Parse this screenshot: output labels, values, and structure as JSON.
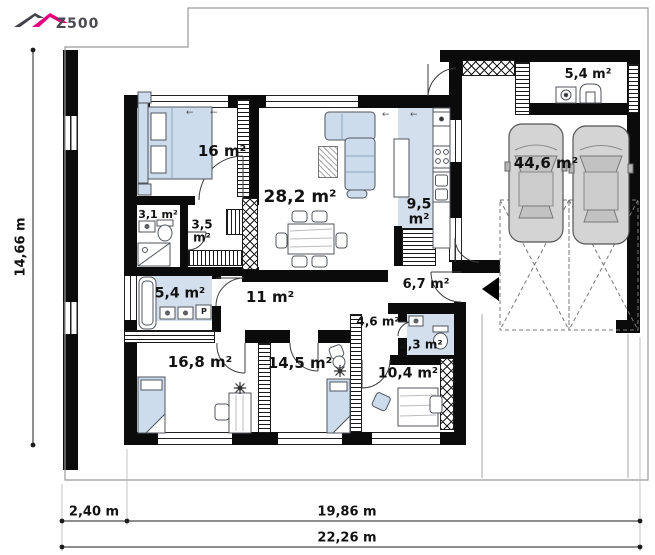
{
  "logo": {
    "brand": "Z500"
  },
  "rooms": [
    {
      "name": "utility-room",
      "area": "5,4 m²"
    },
    {
      "name": "bedroom-1",
      "area": "16 m²"
    },
    {
      "name": "living-room",
      "area": "28,2 m²"
    },
    {
      "name": "kitchen",
      "area": "9,5 m²"
    },
    {
      "name": "garage",
      "area": "44,6 m²"
    },
    {
      "name": "wc",
      "area": "3,1 m²"
    },
    {
      "name": "wardrobe",
      "area": "3,5 m²"
    },
    {
      "name": "bathroom",
      "area": "5,4 m²"
    },
    {
      "name": "hall",
      "area": "11 m²"
    },
    {
      "name": "entry-hall",
      "area": "6,7 m²"
    },
    {
      "name": "corridor",
      "area": "4,6 m²"
    },
    {
      "name": "wc-2",
      "area": "2,3 m²"
    },
    {
      "name": "bedroom-2",
      "area": "16,8 m²"
    },
    {
      "name": "bedroom-3",
      "area": "14,5 m²"
    },
    {
      "name": "bedroom-4",
      "area": "10,4 m²"
    }
  ],
  "dimensions": {
    "left": "14,66 m",
    "bottom_left": "2,40 m",
    "bottom_main": "19,86 m",
    "bottom_total": "22,26 m"
  },
  "labels": {
    "washing_machine": "P"
  },
  "glyphs": {
    "window_arrow": "←"
  },
  "colors": {
    "wall": "#0b0b0b",
    "furniture_fill": "#ccdcec",
    "floor_highlight": "#d4dfee",
    "logo_accent": "#e5007d",
    "car_body": "#d4d4d4",
    "property_line": "#999999"
  }
}
